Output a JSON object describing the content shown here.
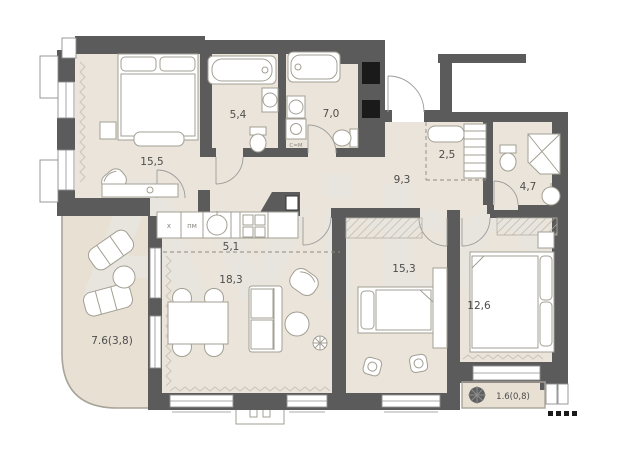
{
  "floorplan": {
    "watermark": "Avito",
    "colors": {
      "wall": "#5b5b5b",
      "floor": "#eae4da",
      "balcony_floor": "#e7e0d3",
      "furn_line": "#a39f93",
      "label": "#4d4d4d",
      "watermark": "#e8e5de"
    },
    "rooms": [
      {
        "id": "bedroom-master",
        "area_label": "15,5"
      },
      {
        "id": "bathroom-1",
        "area_label": "5,4"
      },
      {
        "id": "bathroom-2",
        "area_label": "7,0"
      },
      {
        "id": "hallway",
        "area_label": "9,3"
      },
      {
        "id": "wardrobe-niche",
        "area_label": "2,5"
      },
      {
        "id": "bathroom-3",
        "area_label": "4,7"
      },
      {
        "id": "kitchen-zone",
        "area_label": "5,1"
      },
      {
        "id": "living-room",
        "area_label": "18,3"
      },
      {
        "id": "bedroom-2",
        "area_label": "15,3"
      },
      {
        "id": "bedroom-3",
        "area_label": "12,6"
      },
      {
        "id": "balcony-large",
        "area_label": "7.6(3,8)"
      },
      {
        "id": "balcony-small",
        "area_label": "1.6(0,8)"
      }
    ],
    "appliances": {
      "fridge": "х",
      "dishwasher": "пм",
      "washing_machine": "С=М"
    }
  }
}
